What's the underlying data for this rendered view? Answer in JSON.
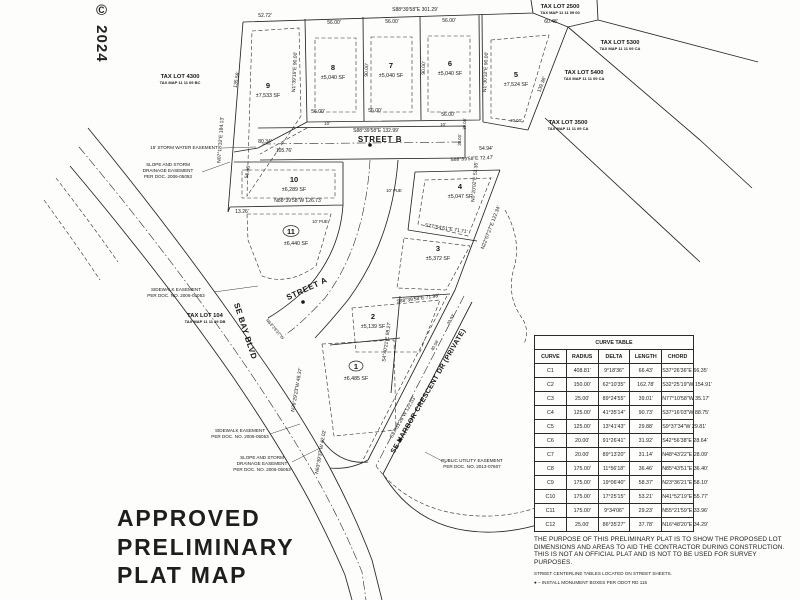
{
  "watermark": "© 2024",
  "title_block": {
    "line1": "APPROVED",
    "line2": "PRELIMINARY",
    "line3": "PLAT MAP"
  },
  "streets": {
    "street_a": "STREET A",
    "street_b": "STREET B",
    "bay_blvd": "SE BAY BLVD",
    "harbor": "SE HARBOR CRESCENT DR (PRIVATE)"
  },
  "lots": {
    "l1": {
      "number": "1",
      "area": "±6,485 SF"
    },
    "l2": {
      "number": "2",
      "area": "±5,139 SF"
    },
    "l3": {
      "number": "3",
      "area": "±5,372 SF"
    },
    "l4": {
      "number": "4",
      "area": "±5,047 SF"
    },
    "l5": {
      "number": "5",
      "area": "±7,524 SF"
    },
    "l6": {
      "number": "6",
      "area": "±5,040 SF"
    },
    "l7": {
      "number": "7",
      "area": "±5,040 SF"
    },
    "l8": {
      "number": "8",
      "area": "±5,040 SF"
    },
    "l9": {
      "number": "9",
      "area": "±7,533 SF"
    },
    "l10": {
      "number": "10",
      "area": "±6,289 SF"
    },
    "l11": {
      "number": "11",
      "area": "±6,440 SF"
    }
  },
  "tax_lots": {
    "t2500": {
      "name": "TAX LOT 2500",
      "map": "TAX MAP 11 11 09 00"
    },
    "t5300": {
      "name": "TAX LOT 5300",
      "map": "TAX MAP 11 11 09 CA"
    },
    "t5400": {
      "name": "TAX LOT 5400",
      "map": "TAX MAP 11 11 09 CA"
    },
    "t3500": {
      "name": "TAX LOT 3500",
      "map": "TAX MAP 11 11 09 CA"
    },
    "t4300": {
      "name": "TAX LOT 4300",
      "map": "TAX MAP 11 11 09 BC"
    },
    "t104": {
      "name": "TAX LOT 104",
      "map": "TAX MAP 11 11 09 DB"
    }
  },
  "easements": {
    "storm_water": "15' STORM WATER EASEMENT",
    "slope_l1": "SLOPE AND STORM",
    "slope_l2": "DRAINAGE EASEMENT",
    "slope_l3": "PER DOC. 2006-05053",
    "slope2_l3": "PER DOC. NO. 2006-05053",
    "sidewalk_l1": "SIDEWALK EASEMENT",
    "sidewalk_l2": "PER DOC. NO. 2006-05053",
    "pue_l1": "PUBLIC UTILITY EASEMENT",
    "pue_l2": "PER DOC. NO. 2013-07607",
    "pue10": "10' PUE"
  },
  "dims": {
    "top_bearing": "S88°39'58\"E  301.29'",
    "w5272": "52.72'",
    "w5600": "56.00'",
    "w6048": "60.48'",
    "west_line": "N07°18'32\"E 184.13'",
    "w13556": "135.56'",
    "n13916": "N1°39'16\"E 90.00'",
    "w9000": "90.00'",
    "n13032": "N1°30'32\"E 90.00'",
    "w13938": "139.38'",
    "streetb_bearing": "S88°39'58\"E  132.99'",
    "w12673": "N88°39'58\"W 126.73'",
    "w8034": "80.34'",
    "w10576": "105.76'",
    "w5636": "56.36'",
    "w1326": "13.26'",
    "w5494": "54.94'",
    "e7247": "S88°39'58\"E  72.47'",
    "n220727": "N22°07'27\"E  122.34'",
    "s775451": "S77°54'51\"E  71.71'",
    "n02002": "N0°20'02\"E 52.35'",
    "w3000": "30.00'",
    "w2000": "20.00'",
    "s44021": "S4°40'21\"E 98.27'",
    "e7198": "S88°39'58\"E 71.98'",
    "s373128": "S37°31'28\"W 122.03'",
    "n262923": "N26°29'23\"W 48.37'",
    "n633937": "N63°39'37\"W 42.02'",
    "w4056": "40.56'",
    "w3393": "33.93'",
    "n632937": "N63°29'37\"W",
    "w10": "10'"
  },
  "curve_table": {
    "title": "CURVE TABLE",
    "columns": {
      "c1": "CURVE",
      "c2": "RADIUS",
      "c3": "DELTA",
      "c4": "LENGTH",
      "c5": "CHORD"
    },
    "rows": [
      {
        "curve": "C1",
        "radius": "408.81'",
        "delta": "9°18'36\"",
        "length": "66.43'",
        "chord": "S37°26'36\"E  66.35'"
      },
      {
        "curve": "C2",
        "radius": "150.00'",
        "delta": "62°10'35\"",
        "length": "162.78'",
        "chord": "S32°25'19\"W  154.91'"
      },
      {
        "curve": "C3",
        "radius": "25.00'",
        "delta": "89°24'55\"",
        "length": "39.01'",
        "chord": "N77°10'58\"W  35.17'"
      },
      {
        "curve": "C4",
        "radius": "125.00'",
        "delta": "41°35'14\"",
        "length": "90.73'",
        "chord": "S37°16'03\"W  88.75'"
      },
      {
        "curve": "C5",
        "radius": "125.00'",
        "delta": "13°41'43\"",
        "length": "29.88'",
        "chord": "S9°37'34\"W  29.81'"
      },
      {
        "curve": "C6",
        "radius": "20.00'",
        "delta": "91°26'41\"",
        "length": "31.92'",
        "chord": "S42°56'38\"E  28.64'"
      },
      {
        "curve": "C7",
        "radius": "20.00'",
        "delta": "89°13'20\"",
        "length": "31.14'",
        "chord": "N48°43'22\"E  28.09'"
      },
      {
        "curve": "C8",
        "radius": "175.00'",
        "delta": "11°56'18\"",
        "length": "36.46'",
        "chord": "N85°43'51\"E  36.40'"
      },
      {
        "curve": "C9",
        "radius": "175.00'",
        "delta": "19°06'40\"",
        "length": "58.37'",
        "chord": "N23°36'21\"E  58.10'"
      },
      {
        "curve": "C10",
        "radius": "175.00'",
        "delta": "17°25'15\"",
        "length": "53.21'",
        "chord": "N41°52'19\"E  55.77'"
      },
      {
        "curve": "C11",
        "radius": "175.00'",
        "delta": "9°34'06\"",
        "length": "29.23'",
        "chord": "N55°21'59\"E  33.96'"
      },
      {
        "curve": "C12",
        "radius": "25.00'",
        "delta": "86°35'27\"",
        "length": "37.78'",
        "chord": "N16°48'20\"E  34.29'"
      }
    ]
  },
  "notes": {
    "purpose": "THE PURPOSE OF THIS PRELIMINARY PLAT IS TO SHOW THE PROPOSED LOT DIMENSIONS AND AREAS TO AID THE CONTRACTOR DURING CONSTRUCTION. THIS IS NOT AN OFFICIAL PLAT AND IS NOT TO BE USED FOR SURVEY PURPOSES.",
    "centerline": "STREET CENTERLINE TABLES LOCATED ON STREET SHEETS.",
    "monument_bullet": "●",
    "monument": " – INSTALL MONUMENT BOXES PER ODOT RD 115"
  }
}
